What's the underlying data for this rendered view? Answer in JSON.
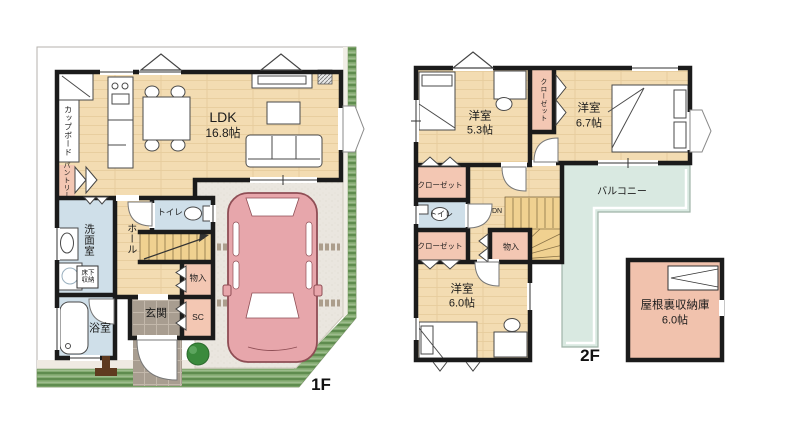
{
  "plan_title": "2-story house floor plan",
  "colors": {
    "wall": "#1b1b1b",
    "wood_floor": "#f3dcb2",
    "wet_room_blue": "#cfdfe9",
    "closet_pink": "#f3c7b3",
    "entrance_tile": "#a89d90",
    "driveway": "#eae6df",
    "grass_green": "#5f8c4f",
    "balcony_teal": "#d9e9e1",
    "attic_pink": "#f1c2ad",
    "car_pink": "#e7a6ab"
  },
  "f1": {
    "floor_label": "1F",
    "ldk": {
      "name": "LDK",
      "size": "16.8帖"
    },
    "cupboard": "カップボード",
    "pantry": "パントリー",
    "washroom": "洗面室",
    "underfloor_l1": "床下",
    "underfloor_l2": "収納",
    "hall": "ホール",
    "toilet": "トイレ",
    "storage": "物入",
    "shoe_closet": "SC",
    "entrance": "玄関",
    "bath": "浴室"
  },
  "f2": {
    "floor_label": "2F",
    "room53": {
      "name": "洋室",
      "size": "5.3帖"
    },
    "room67": {
      "name": "洋室",
      "size": "6.7帖"
    },
    "room60": {
      "name": "洋室",
      "size": "6.0帖"
    },
    "closet_vertical": "クローゼット",
    "closet_a": "クローゼット",
    "closet_b": "クローゼット",
    "toilet": "トイレ",
    "down_mark": "DN",
    "storage": "物入",
    "balcony": "バルコニー",
    "attic": {
      "name": "屋根裏収納庫",
      "size": "6.0帖"
    }
  }
}
